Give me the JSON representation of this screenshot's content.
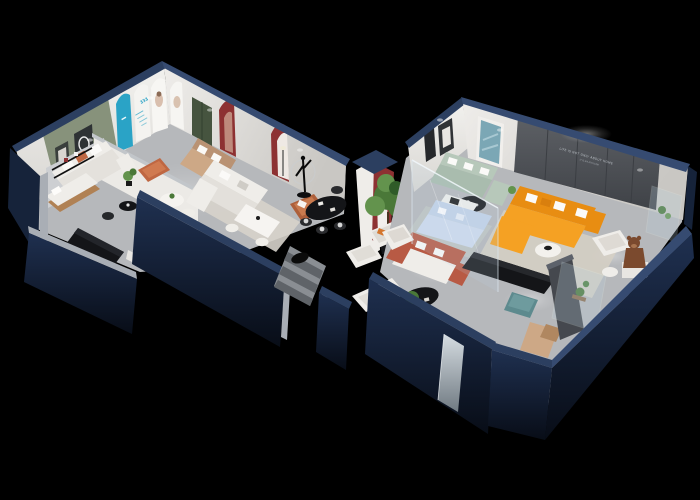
{
  "scene": {
    "type": "isometric-3d-cutaway-floorplan-render",
    "subject": "furniture showroom interior, viewed from above at an angle, roof removed",
    "view": "isometric cutaway from the south-west",
    "background": "#000000"
  },
  "palette": {
    "background": "#000000",
    "navy_face": "#16233a",
    "navy_face_dark": "#0a1220",
    "navy_cap": "#2c3f60",
    "navy_cap_light": "#364b71",
    "cut_gray": "#a9aeb5",
    "floor": "#b6b8bb",
    "floor_light": "#cdcfd1",
    "rug_beige": "#d6d0c4",
    "rug_gray": "#d7d3cb",
    "wall_white": "#eae8e4",
    "wall_shadow": "#cfcdc9",
    "wall_green": "#87927b",
    "wall_dark": "#54575c",
    "accent_red": "#8d3132",
    "accent_cyan": "#2aa3c6",
    "door_green": "#46543f",
    "sofa_white": "#efede9",
    "sofa_orange": "#f5a123",
    "sofa_orange_dark": "#e88d12",
    "sofa_sage": "#b7c8ba",
    "sofa_blue": "#c3d2e8",
    "sofa_tan": "#cda886",
    "terracotta": "#bf6742",
    "coral": "#b85a44",
    "rust": "#ad5f3a",
    "table_black": "#141518",
    "wood": "#b08154",
    "plant": "#4a7838",
    "plant_light": "#63934d",
    "teal": "#5d8a8e",
    "teddy": "#7b4a2e",
    "glass": "#bcd3e2",
    "mirror": "#c9d2d8"
  },
  "texts": {
    "arch_poster_number": "333",
    "wall_slogan_line1": "LIFE IS NOT ONLY ABOUT HOME",
    "wall_slogan_line2": "IT IS AN ATTITUDE"
  },
  "areas": [
    {
      "name": "display-wall-left",
      "items": [
        "sage-green-accent-wall",
        "framed-artworks",
        "cyan-arch-panel",
        "infographic-arch-poster",
        "portrait-arch-panels",
        "dark-green-door",
        "red-arch-niches",
        "arch-floor-lamp"
      ]
    },
    {
      "name": "lounge-left",
      "items": [
        "white-sofa-with-orange-pillows",
        "terracotta-ottoman",
        "tan-leather-sofa",
        "round-dining-table",
        "dining-chairs",
        "potted-plant",
        "black-coffee-table",
        "desk-chair"
      ]
    },
    {
      "name": "studio-left",
      "items": [
        "daybed",
        "black-wall-shelf",
        "long-black-display-console",
        "white-pedestal"
      ]
    },
    {
      "name": "entry",
      "items": [
        "striped-walkway-mat",
        "black-oval-logo-mat",
        "white-column-with-red-arch",
        "human-figure-sculpture",
        "black-oval-dining-table",
        "black-dining-chairs",
        "large-potted-tree",
        "cream-armchairs"
      ]
    },
    {
      "name": "living-room-center",
      "items": [
        "white-l-shaped-sofa",
        "white-dining-table",
        "white-chairs",
        "rust-armchair",
        "gray-rug",
        "floor-lamp"
      ]
    },
    {
      "name": "glass-showcase",
      "items": [
        "glass-partition",
        "light-blue-sofa-set",
        "white-media-unit",
        "white-terracotta-sofa",
        "black-oval-coffee-table",
        "white-armchair"
      ]
    },
    {
      "name": "lounge-right",
      "items": [
        "orange-l-shaped-sofa",
        "white-throw-pillows",
        "round-white-coffee-table",
        "black-media-console",
        "sage-green-sectional",
        "round-black-coffee-table",
        "teal-abstract-artwork",
        "dark-feature-wall-with-slogan",
        "white-armchair",
        "teddy-bear-figure",
        "white-stool",
        "black-framed-art"
      ]
    },
    {
      "name": "south-corner-right",
      "items": [
        "teal-ottoman",
        "tan-chaise-lounge",
        "dark-gray-partition",
        "glass-display-cabinet-with-cactus",
        "mirror-panel-on-facade",
        "corner-glass-plant-case"
      ]
    }
  ]
}
